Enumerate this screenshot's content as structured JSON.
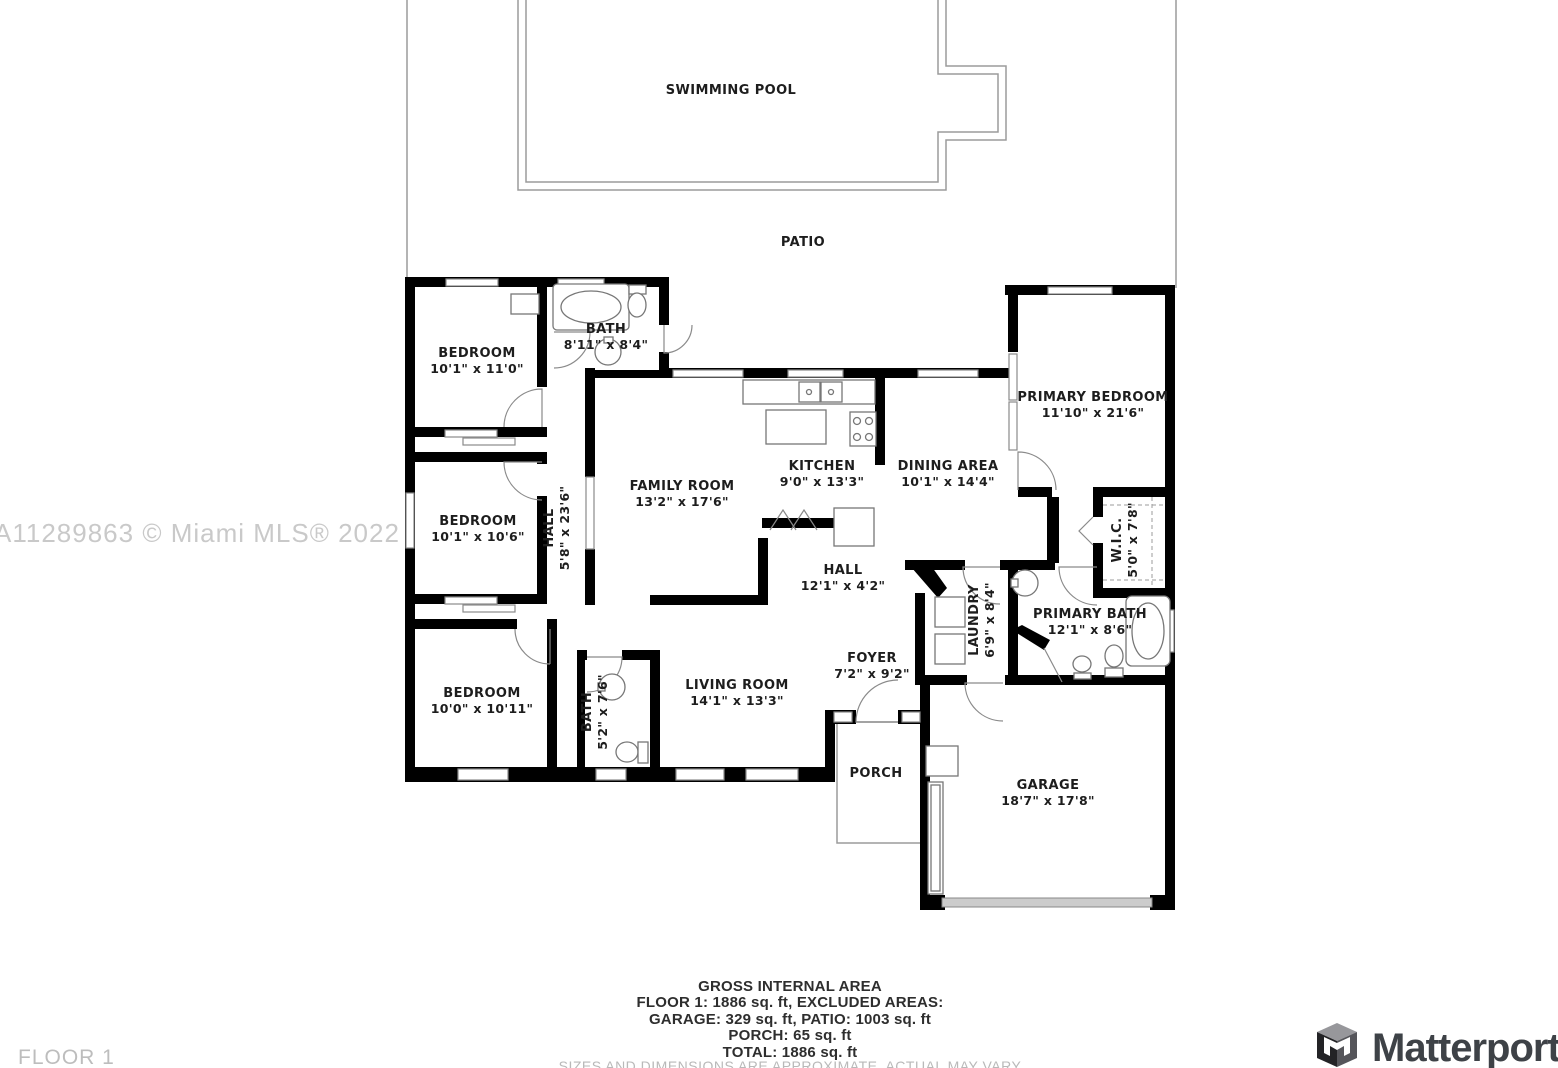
{
  "watermark": "A11289863 © Miami MLS® 2022",
  "floor_label": "FLOOR 1",
  "brand": {
    "name": "Matterport"
  },
  "labels": {
    "swimming_pool": "SWIMMING POOL",
    "patio": "PATIO",
    "porch": "PORCH",
    "bedroom1_name": "BEDROOM",
    "bedroom1_dims": "10'1\" x 11'0\"",
    "bath1_name": "BATH",
    "bath1_dims": "8'11\" x 8'4\"",
    "bedroom2_name": "BEDROOM",
    "bedroom2_dims": "10'1\" x 10'6\"",
    "hall1_name": "HALL",
    "hall1_dims": "5'8\" x 23'6\"",
    "bedroom3_name": "BEDROOM",
    "bedroom3_dims": "10'0\" x 10'11\"",
    "bath2_name": "BATH",
    "bath2_dims": "5'2\" x 7'6\"",
    "family_name": "FAMILY ROOM",
    "family_dims": "13'2\" x 17'6\"",
    "kitchen_name": "KITCHEN",
    "kitchen_dims": "9'0\" x 13'3\"",
    "dining_name": "DINING AREA",
    "dining_dims": "10'1\" x 14'4\"",
    "primary_bedroom_name": "PRIMARY BEDROOM",
    "primary_bedroom_dims": "11'10\" x 21'6\"",
    "wic_name": "W.I.C.",
    "wic_dims": "5'0\" x 7'8\"",
    "primary_bath_name": "PRIMARY BATH",
    "primary_bath_dims": "12'1\" x 8'6\"",
    "hall2_name": "HALL",
    "hall2_dims": "12'1\" x 4'2\"",
    "laundry_name": "LAUNDRY",
    "laundry_dims": "6'9\" x 8'4\"",
    "foyer_name": "FOYER",
    "foyer_dims": "7'2\" x 9'2\"",
    "living_name": "LIVING ROOM",
    "living_dims": "14'1\" x 13'3\"",
    "garage_name": "GARAGE",
    "garage_dims": "18'7\" x 17'8\""
  },
  "summary": {
    "title": "GROSS INTERNAL AREA",
    "line1": "FLOOR 1: 1886 sq. ft, EXCLUDED AREAS:",
    "line2": "GARAGE: 329 sq. ft, PATIO: 1003 sq. ft",
    "line3": "PORCH: 65 sq. ft",
    "line4": "TOTAL: 1886 sq. ft",
    "disclaimer": "SIZES AND DIMENSIONS ARE APPROXIMATE, ACTUAL MAY VARY"
  }
}
